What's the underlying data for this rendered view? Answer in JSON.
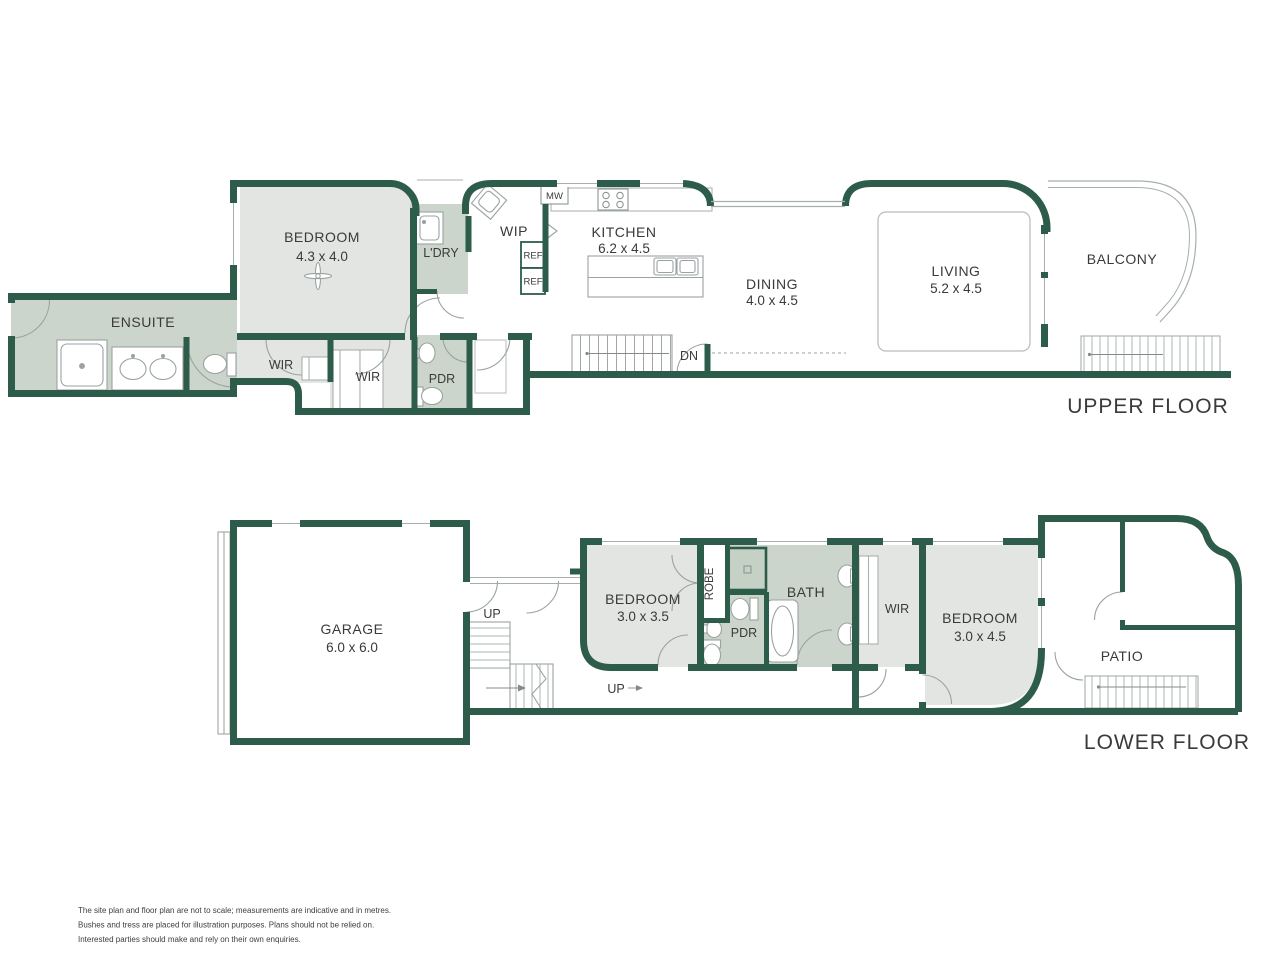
{
  "colors": {
    "wall": "#2d5c4a",
    "room_gray": "#e3e5e3",
    "room_sage": "#ccd5cb",
    "fixture_line": "#9aa2a2",
    "text": "#3a3a3a"
  },
  "upper": {
    "title": "UPPER FLOOR",
    "ensuite": "ENSUITE",
    "bedroom_label": "BEDROOM",
    "bedroom_dims": "4.3 x 4.0",
    "ldry": "L'DRY",
    "wip": "WIP",
    "mw": "MW",
    "ref1": "REF",
    "ref2": "REF",
    "kitchen_label": "KITCHEN",
    "kitchen_dims": "6.2 x 4.5",
    "dining_label": "DINING",
    "dining_dims": "4.0 x 4.5",
    "living_label": "LIVING",
    "living_dims": "5.2 x 4.5",
    "balcony": "BALCONY",
    "wir1": "WIR",
    "wir2": "WIR",
    "pdr": "PDR",
    "dn": "DN"
  },
  "lower": {
    "title": "LOWER FLOOR",
    "garage_label": "GARAGE",
    "garage_dims": "6.0 x 6.0",
    "up1": "UP",
    "up2": "UP",
    "bedroom1_label": "BEDROOM",
    "bedroom1_dims": "3.0 x 3.5",
    "robe": "ROBE",
    "pdr": "PDR",
    "bath": "BATH",
    "wir": "WIR",
    "bedroom2_label": "BEDROOM",
    "bedroom2_dims": "3.0 x 4.5",
    "patio": "PATIO"
  },
  "disclaimer": {
    "line1": "The site plan and floor plan are not to scale; measurements are indicative and in metres.",
    "line2": "Bushes and tress are placed for illustration purposes. Plans should not be relied on.",
    "line3": "Interested parties should make and rely on their own enquiries."
  }
}
